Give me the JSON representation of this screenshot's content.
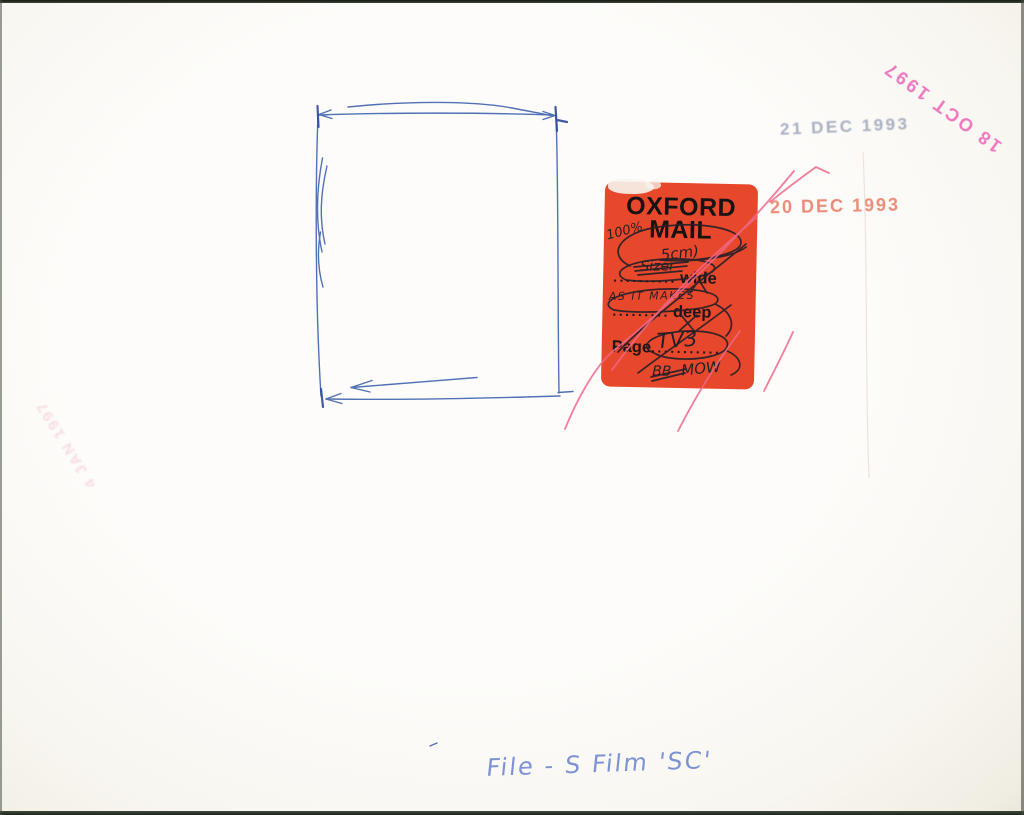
{
  "colors": {
    "paper": "#fbf9f4",
    "sticker_red": "#e7482b",
    "blue_pen": "#3f62ae",
    "red_pen": "#f0688a",
    "black_ink": "#262028",
    "stamp_grey": "#9aa2b8",
    "stamp_pink": "#ee58b4",
    "stamp_salmon": "#ec8875",
    "stamp_faint_pink": "#efa9bb",
    "handwriting_blue": "#7e93d4"
  },
  "sticker": {
    "title_line1": "OXFORD",
    "title_line2": "MAIL",
    "rows": {
      "wide_dots": "..........",
      "wide_label": "wide",
      "deep_dots": ".........",
      "deep_label": "deep",
      "page_label": "Page",
      "page_dots": "..........."
    },
    "handwriting": {
      "top_note": "100%",
      "size_note": "5cm)",
      "struck_word": "Sizer",
      "fit_note": "AS IT MAKES",
      "page_note": "TV3",
      "struck_initials": "BB",
      "initials_note": "MOW"
    }
  },
  "stamps": [
    {
      "id": "dec-1993-grey",
      "text": "21 DEC 1993",
      "color": "#9aa2b8"
    },
    {
      "id": "oct-1997-pink",
      "text": "18 OCT 1997",
      "color": "#ee58b4"
    },
    {
      "id": "dec-1993-salmon",
      "text": "20 DEC 1993",
      "color": "#ec8875"
    },
    {
      "id": "jan-1997-faint",
      "text": "4 JAN 1997",
      "color": "#efa9bb"
    }
  ],
  "bottom_note": {
    "text": "File - S Film 'SC'"
  }
}
